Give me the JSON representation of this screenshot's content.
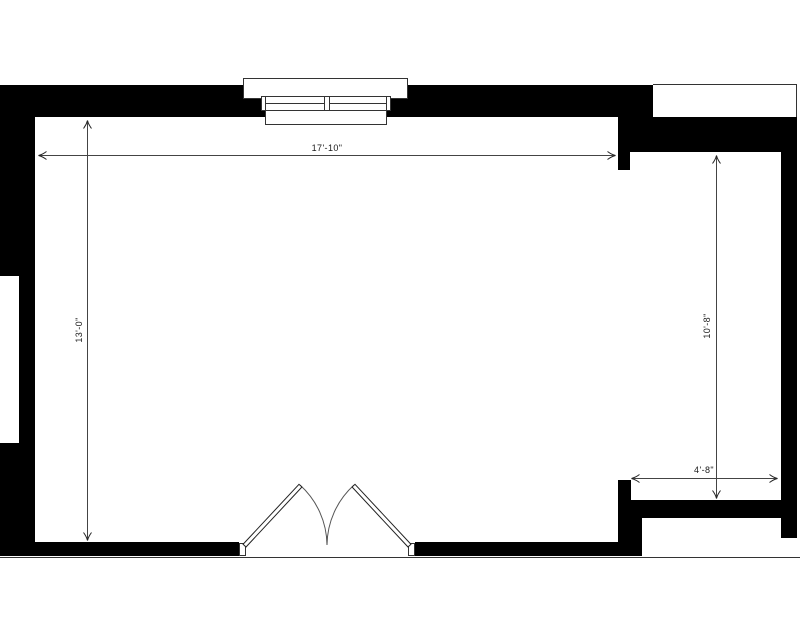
{
  "plan": {
    "title": "room-floor-plan",
    "dimensions": {
      "room_width": "17'-10\"",
      "room_height": "13'-0\"",
      "alcove_height": "10'-8\"",
      "alcove_width": "4'-8\""
    },
    "features": {
      "top_window": "double-casement-window",
      "left_wall_opening": "wall-recess",
      "bottom_doors": "double-swing-doors",
      "right_side": "alcove-opening"
    },
    "colors": {
      "wall": "#000000",
      "background": "#ffffff",
      "outline": "#333333",
      "dimension_line": "#444444",
      "text": "#1a1a1a"
    }
  }
}
